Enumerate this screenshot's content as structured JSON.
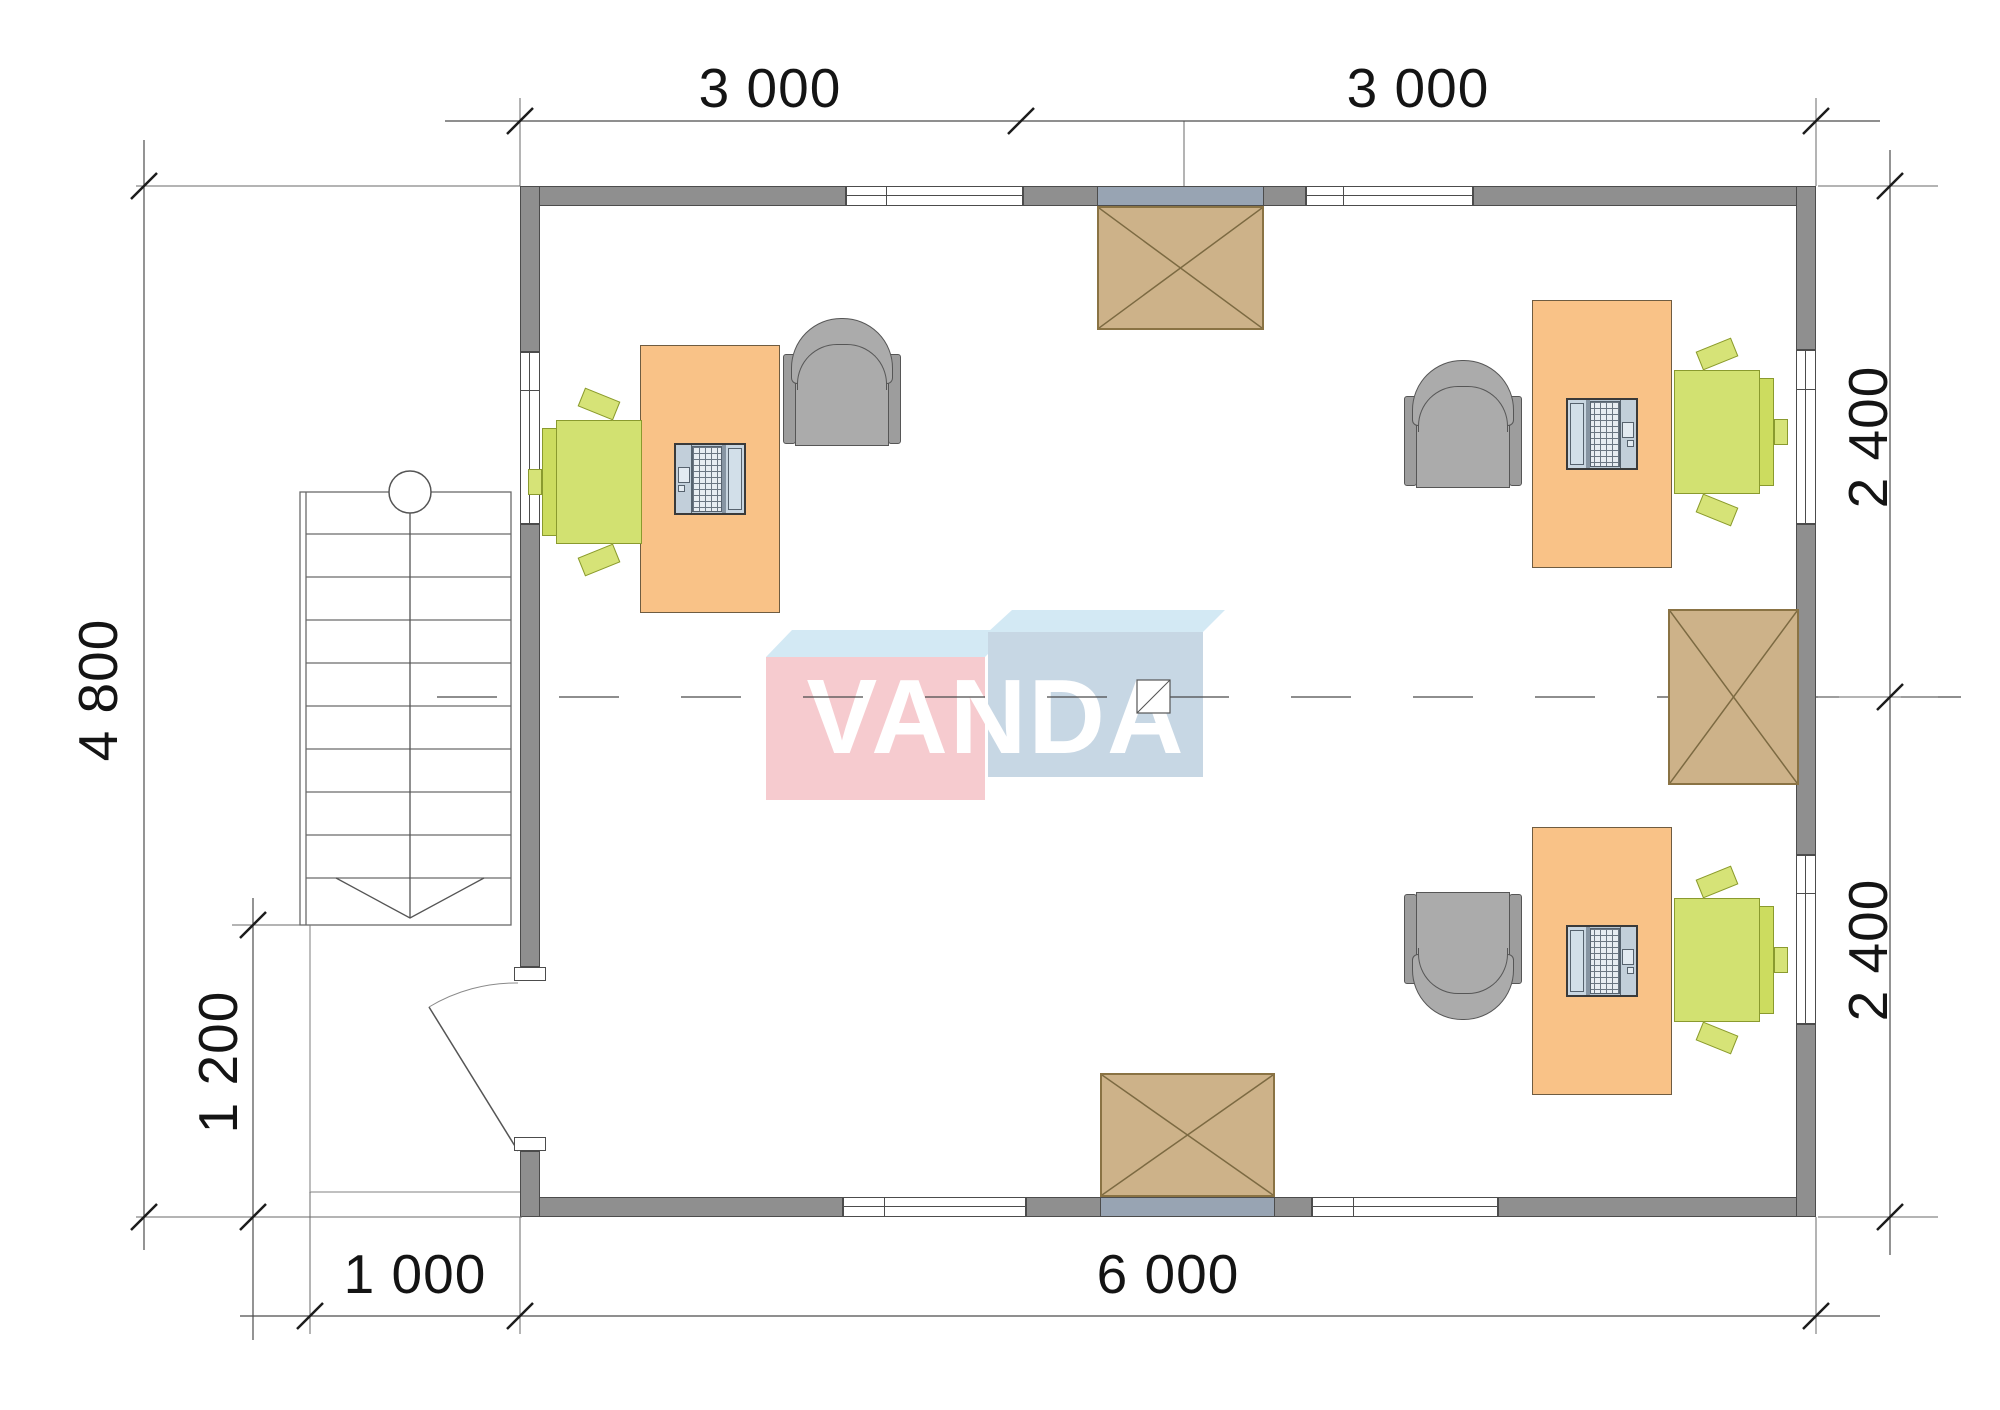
{
  "dimensions": {
    "top": [
      "3 000",
      "3 000"
    ],
    "right": [
      "2 400",
      "2 400"
    ],
    "left_height": "4 800",
    "porch_height": "1 200",
    "porch_width": "1 000",
    "bottom_width": "6 000"
  },
  "logo": {
    "text": "VANDA"
  },
  "colors": {
    "wall": "#8f8f8f",
    "wall_outline": "#4c4c4c",
    "canopy_wall_tint": "#98a4b3",
    "desk": "#f9c287",
    "task_chair_green": "#d2e171",
    "armchair_gray": "#ababab",
    "hatch_box_tan": "#cdb289",
    "logo_pink": "#f6c6ca",
    "logo_blue": "#c2d3e2",
    "logo_top_face": "#cfe7f3",
    "dimension_text": "#141414"
  }
}
